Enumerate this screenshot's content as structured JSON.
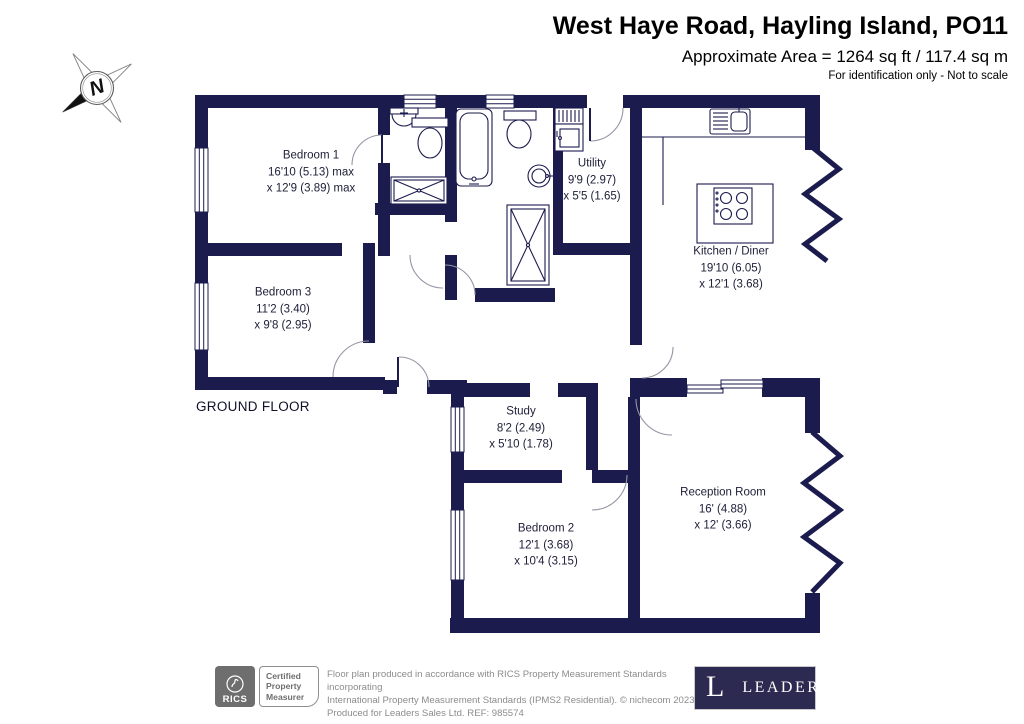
{
  "header": {
    "title": "West Haye Road, Hayling Island, PO11",
    "area": "Approximate Area = 1264 sq ft / 117.4 sq m",
    "note": "For identification only - Not to scale"
  },
  "compass": {
    "north": "N"
  },
  "plan": {
    "floor_label": "GROUND FLOOR",
    "rooms": [
      {
        "id": "bedroom-1",
        "name": "Bedroom 1",
        "dim1": "16'10 (5.13) max",
        "dim2": "x 12'9 (3.89) max"
      },
      {
        "id": "bedroom-3",
        "name": "Bedroom 3",
        "dim1": "11'2 (3.40)",
        "dim2": "x 9'8 (2.95)"
      },
      {
        "id": "utility",
        "name": "Utility",
        "dim1": "9'9 (2.97)",
        "dim2": "x 5'5 (1.65)"
      },
      {
        "id": "kitchen-diner",
        "name": "Kitchen / Diner",
        "dim1": "19'10 (6.05)",
        "dim2": "x 12'1 (3.68)"
      },
      {
        "id": "study",
        "name": "Study",
        "dim1": "8'2 (2.49)",
        "dim2": "x 5'10 (1.78)"
      },
      {
        "id": "bedroom-2",
        "name": "Bedroom 2",
        "dim1": "12'1 (3.68)",
        "dim2": "x 10'4 (3.15)"
      },
      {
        "id": "reception-room",
        "name": "Reception Room",
        "dim1": "16' (4.88)",
        "dim2": "x 12' (3.66)"
      }
    ]
  },
  "footer": {
    "rics_brand": "RICS",
    "cert_line1": "Certified",
    "cert_line2": "Property",
    "cert_line3": "Measurer",
    "disclaimer_line1": "Floor plan produced in accordance with RICS Property Measurement Standards incorporating",
    "disclaimer_line2": "International Property Measurement Standards (IPMS2 Residential).  © nichecom 2023.",
    "disclaimer_line3": "Produced for Leaders Sales Ltd.   REF:  985574",
    "leaders_initial": "L",
    "leaders_name": "LEADERS"
  },
  "colors": {
    "wall": "#1b1b4e",
    "leaders_bg": "#2d2a52",
    "rics_gray": "#6e6e6e"
  }
}
